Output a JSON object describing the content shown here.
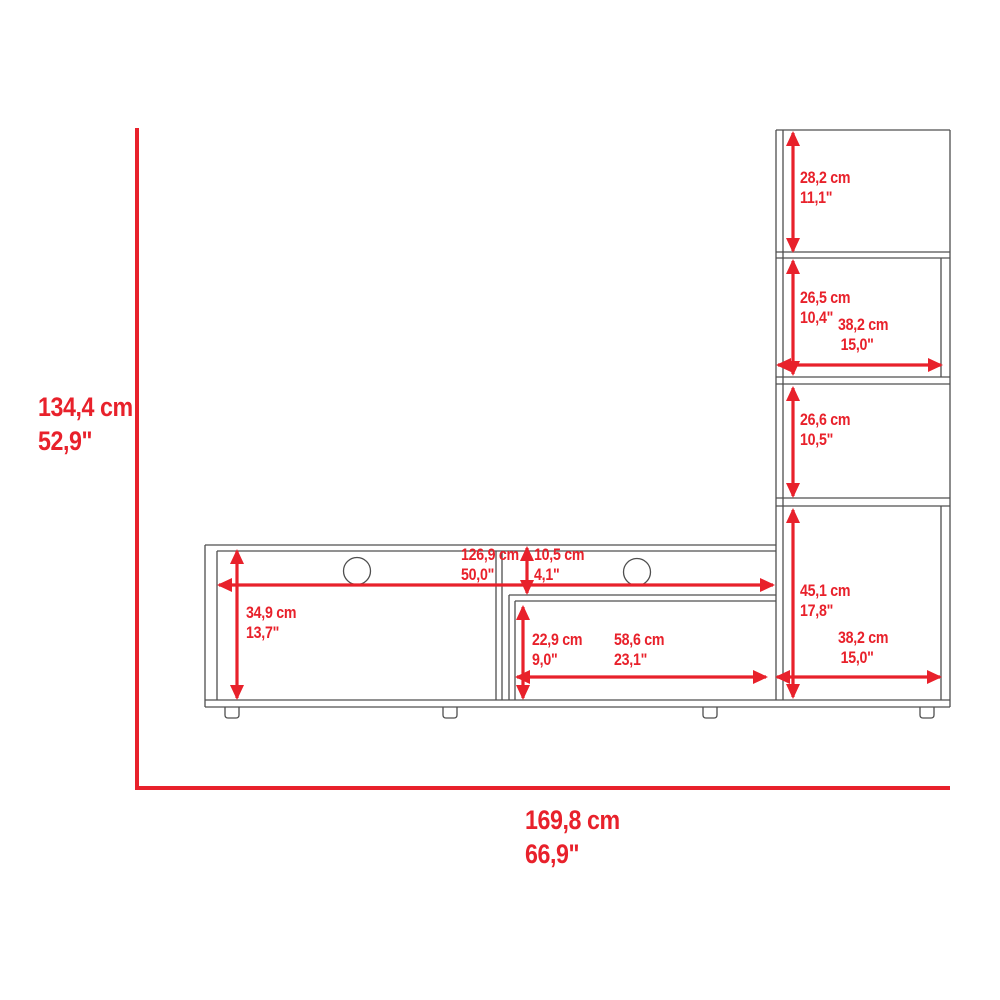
{
  "colors": {
    "dimension": "#e8212b",
    "outline": "#4f4f4f",
    "background": "#ffffff"
  },
  "dims": {
    "overall_height": {
      "cm": "134,4 cm",
      "in": "52,9\""
    },
    "overall_width": {
      "cm": "169,8 cm",
      "in": "66,9\""
    },
    "tower_top_shelf_height": {
      "cm": "28,2 cm",
      "in": "11,1\""
    },
    "tower_second_shelf_height": {
      "cm": "26,5 cm",
      "in": "10,4\""
    },
    "tower_second_shelf_width": {
      "cm": "38,2 cm",
      "in": "15,0\""
    },
    "tower_third_shelf_height": {
      "cm": "26,6 cm",
      "in": "10,5\""
    },
    "tower_bottom_cabinet_height": {
      "cm": "45,1 cm",
      "in": "17,8\""
    },
    "tower_bottom_cabinet_width": {
      "cm": "38,2 cm",
      "in": "15,0\""
    },
    "stand_top_width": {
      "cm": "126,9 cm",
      "in": "50,0\""
    },
    "stand_top_clearance": {
      "cm": "10,5 cm",
      "in": "4,1\""
    },
    "stand_left_compartment_height": {
      "cm": "34,9 cm",
      "in": "13,7\""
    },
    "stand_shelf_height": {
      "cm": "22,9 cm",
      "in": "9,0\""
    },
    "stand_shelf_width": {
      "cm": "58,6 cm",
      "in": "23,1\""
    }
  }
}
